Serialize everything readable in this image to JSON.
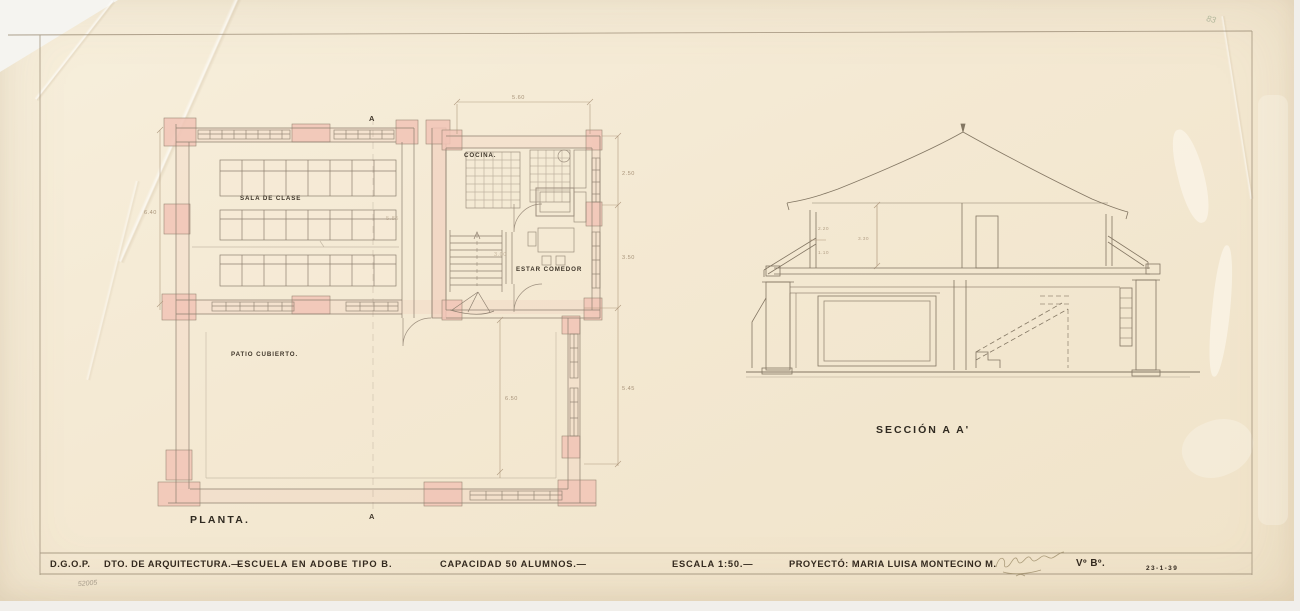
{
  "title_block": {
    "agency": "D.G.O.P.",
    "department": "DTO. DE ARQUITECTURA.—",
    "project": "ESCUELA EN ADOBE TIPO B.",
    "capacity": "CAPACIDAD 50 ALUMNOS.—",
    "scale": "ESCALA 1:50.—",
    "author": "PROYECTÓ: MARIA LUISA MONTECINO M.",
    "approval": "Vº Bº.",
    "date": "23-1-39"
  },
  "plan": {
    "caption": "PLANTA.",
    "rooms": {
      "classroom": "SALA DE CLASE",
      "kitchen": "COCINA.",
      "living_dining": "ESTAR COMEDOR",
      "covered_patio": "PATIO CUBIERTO."
    },
    "dims": {
      "top": "5.60",
      "right_upper": "2.50",
      "right_middle": "3.50",
      "right_lower": "5.45",
      "left": "6.40",
      "patio": "6.50",
      "classroom_width": "5.85",
      "stair_hall": "3.00"
    },
    "section_marker_top": "A",
    "section_marker_bottom": "A"
  },
  "section": {
    "caption": "SECCIÓN A A'",
    "dims": {
      "wall": "2.20",
      "sill": "1.10",
      "room_height": "3.30"
    }
  },
  "annotations": {
    "pencil_number": "52005",
    "corner_mark": "83"
  },
  "colors": {
    "paper": "#f4e9d3",
    "ink": "#33291e",
    "linework": "#8e8070",
    "wall_poche": "#f1c4b6",
    "dim_text": "#a8947a"
  }
}
